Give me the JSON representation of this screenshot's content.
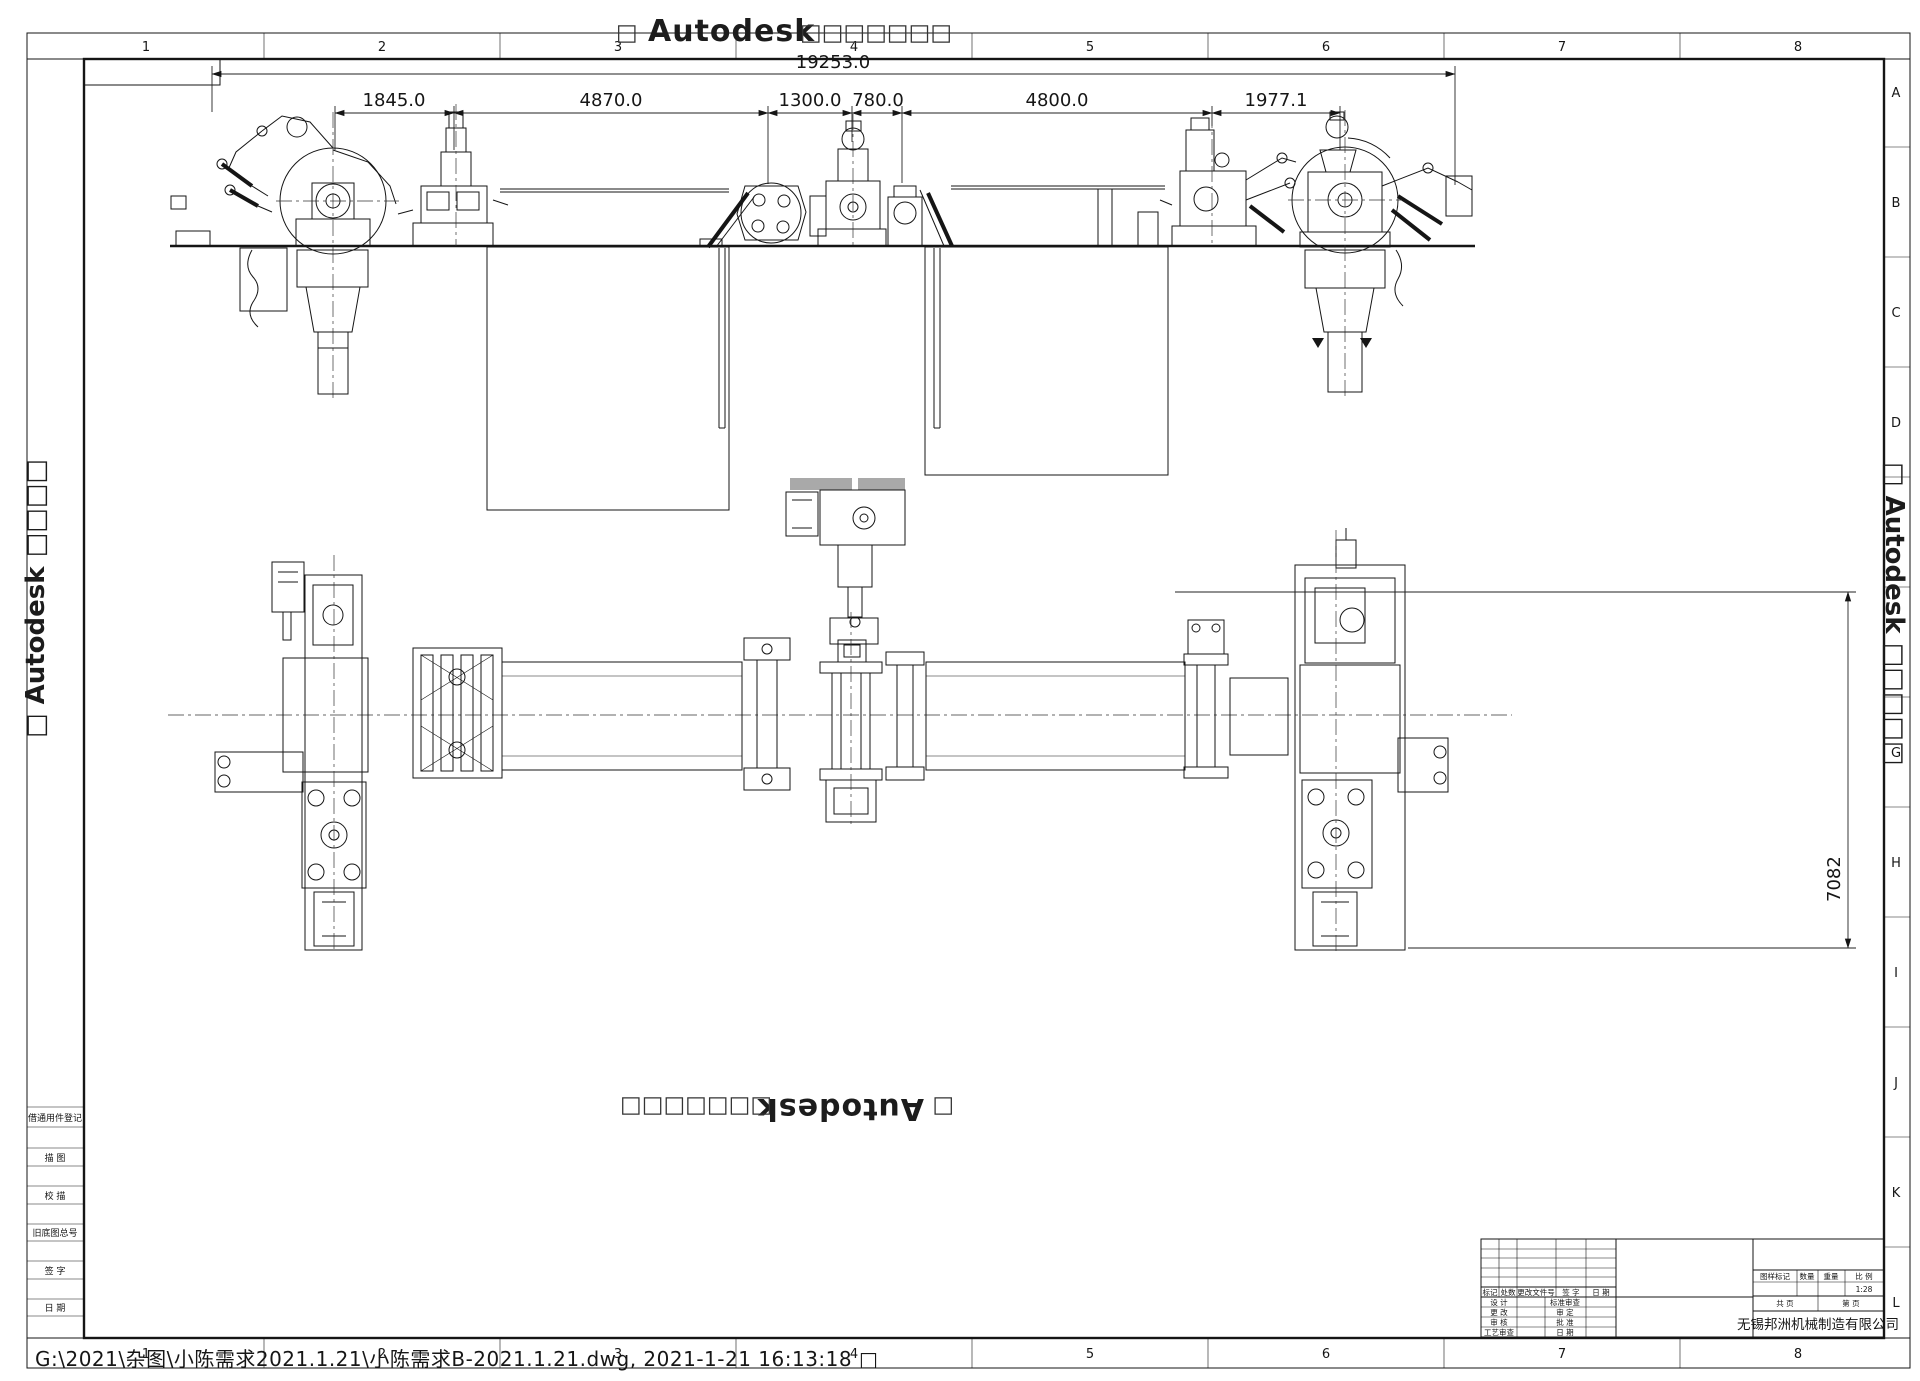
{
  "watermarks": {
    "brand": "Autodesk",
    "box_left": "□",
    "boxes_right": "□□□□□□□",
    "left_vertical": "□ Autodesk □□□□",
    "right_vertical": "□ Autodesk □□□□□"
  },
  "zones": {
    "top": [
      "1",
      "2",
      "3",
      "4",
      "5",
      "6",
      "7",
      "8"
    ],
    "bottom": [
      "1",
      "2",
      "3",
      "4",
      "5",
      "6",
      "7",
      "8"
    ],
    "right": [
      "A",
      "B",
      "C",
      "D",
      "",
      "",
      "G",
      "H",
      "I",
      "J",
      "K",
      "L"
    ]
  },
  "dims": {
    "overall": "19253.0",
    "segments": [
      "1845.0",
      "4870.0",
      "1300.0",
      "780.0",
      "4800.0",
      "1977.1"
    ],
    "plan_height": "7082"
  },
  "side_strip": {
    "labels": [
      "借通用件登记",
      "描 图",
      "校 描",
      "旧底图总号",
      "签 字",
      "日 期"
    ]
  },
  "title_block": {
    "rev_header": [
      "标记",
      "处数",
      "更改文件号",
      "签 字",
      "日 期"
    ],
    "sign_left": [
      "设 计",
      "更 改",
      "审 核",
      "工艺审查"
    ],
    "sign_right": [
      "标准审查",
      "审 定",
      "批 准",
      "日 期"
    ],
    "info_header": [
      "图样标记",
      "数量",
      "重量",
      "比 例"
    ],
    "scale": "1:28",
    "pages": [
      "共  页",
      "第  页"
    ],
    "company": "无锡邦洲机械制造有限公司"
  },
  "status": {
    "file_path": "G:\\2021\\杂图\\小陈需求2021.1.21\\小陈需求B-2021.1.21.dwg,  2021-1-21 16:13:18 □"
  }
}
